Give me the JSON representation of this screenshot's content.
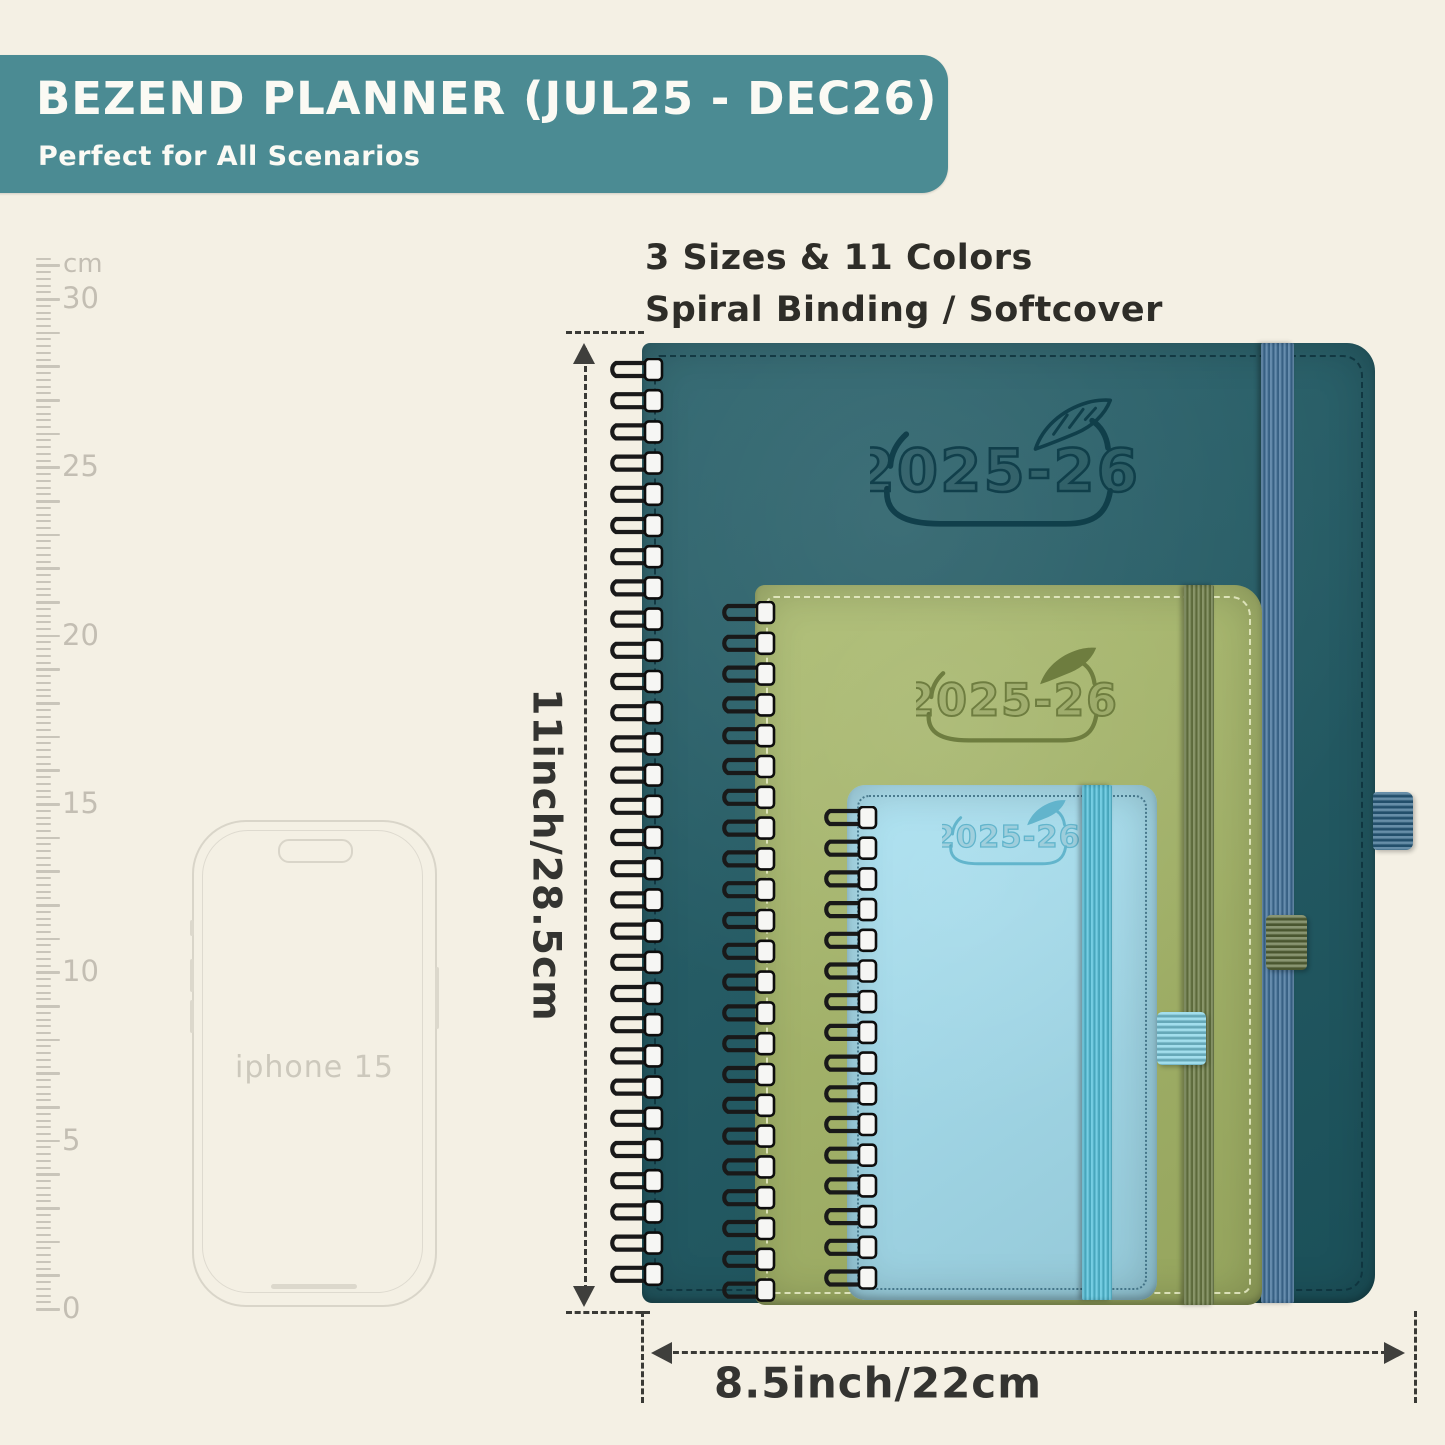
{
  "background_color": "#f4f0e4",
  "banner": {
    "title": "BEZEND PLANNER (JUL25 - DEC26)",
    "subtitle": "Perfect for All Scenarios",
    "bg_color": "#4b8b93",
    "text_color": "#fbfaf4"
  },
  "features": {
    "line1": "3 Sizes & 11 Colors",
    "line2": "Spiral Binding / Softcover"
  },
  "ruler": {
    "unit": "cm",
    "labels": [
      "0",
      "5",
      "10",
      "15",
      "20",
      "25",
      "30"
    ],
    "max_cm": 30
  },
  "phone": {
    "label": "iphone 15"
  },
  "planners": [
    {
      "id": "large",
      "year_label": "2025-26",
      "cover_color": "#1e5963",
      "logo_color": "#0f3d49",
      "band_color": "#41719a",
      "pen_loop_color": "#2c6386"
    },
    {
      "id": "medium",
      "year_label": "2025-26",
      "cover_color": "#a6b768",
      "logo_color": "#6b7a3d",
      "band_color": "#6c7c45",
      "pen_loop_color": "#5c6c3c"
    },
    {
      "id": "small",
      "year_label": "2025-26",
      "cover_color": "#a5dff0",
      "logo_color": "#5fb3cb",
      "band_color": "#54c2dc",
      "pen_loop_color": "#7fd2e6"
    }
  ],
  "dimensions": {
    "height_label": "11inch/28.5cm",
    "width_label": "8.5inch/22cm"
  }
}
